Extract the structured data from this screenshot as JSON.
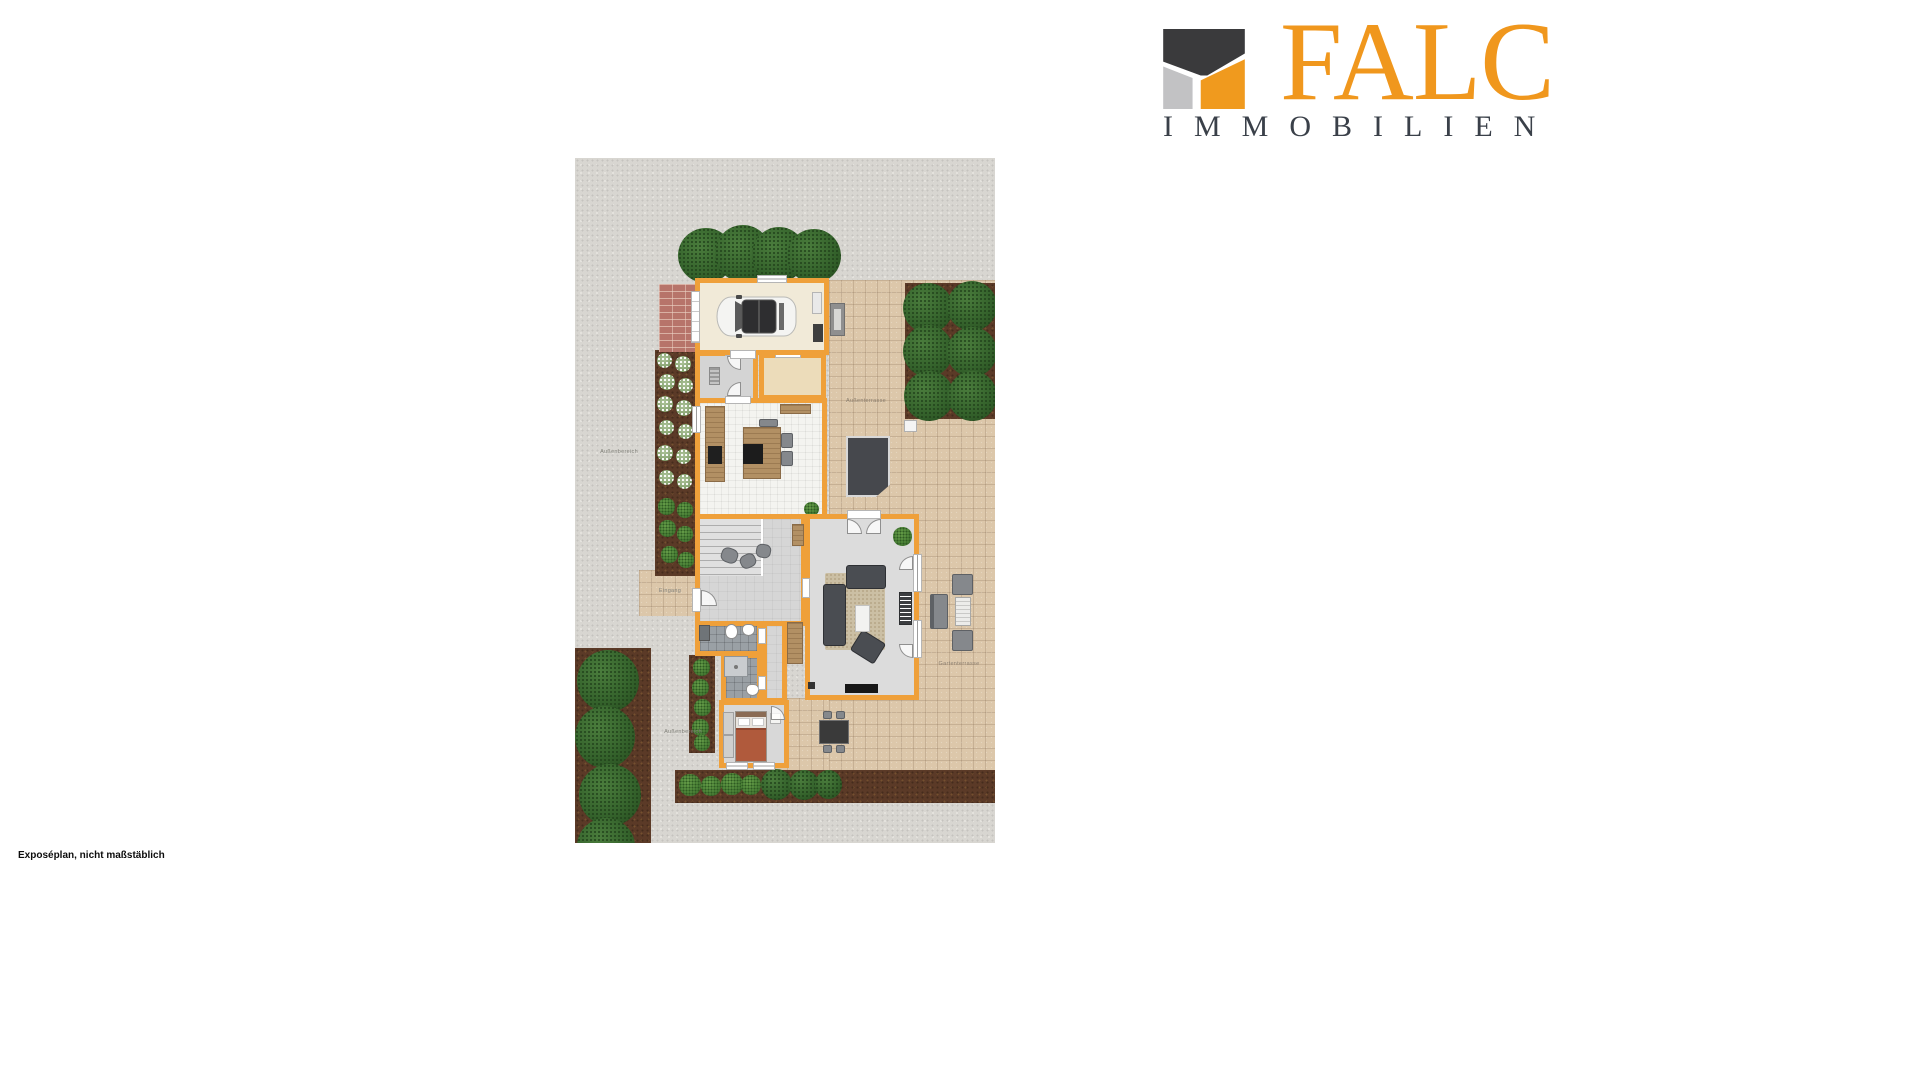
{
  "logo": {
    "brand": "FALC",
    "subtitle": "IMMOBILIEN",
    "brand_color": "#F0971D",
    "subtitle_color": "#3A4049",
    "mark_colors": {
      "dark": "#3A3A3C",
      "gray": "#C2C2C4",
      "orange": "#F09A1E"
    }
  },
  "footer": {
    "note": "Exposéplan, nicht maßstäblich"
  },
  "plan": {
    "labels": {
      "outdoor_left": "Außenbereich",
      "terrace_upper": "Außenterrasse",
      "terrace_lower": "Gartenterrasse",
      "entrance": "Eingang",
      "outdoor_bottom": "Außenbereich"
    },
    "colors": {
      "wall": "#EFA03A",
      "gravel": "#D8D6D1",
      "terrace": "#DCC7AA",
      "dirt": "#5B3A27",
      "brick": "#B7746A",
      "garage_floor": "#F1EAD8",
      "pantry_floor": "#ECDCBA",
      "kitchen_floor": "#F4F4F0",
      "hall_floor": "#D6D6D6",
      "living_floor": "#DCDCDC",
      "bath_floor": "#9AA0A5",
      "bedroom_floor": "#D8D8D8",
      "wood": "#B29064",
      "sofa": "#4A4D52",
      "bed": "#B05A3C",
      "brand": "#F0971D",
      "subtitle": "#3A4049"
    }
  }
}
